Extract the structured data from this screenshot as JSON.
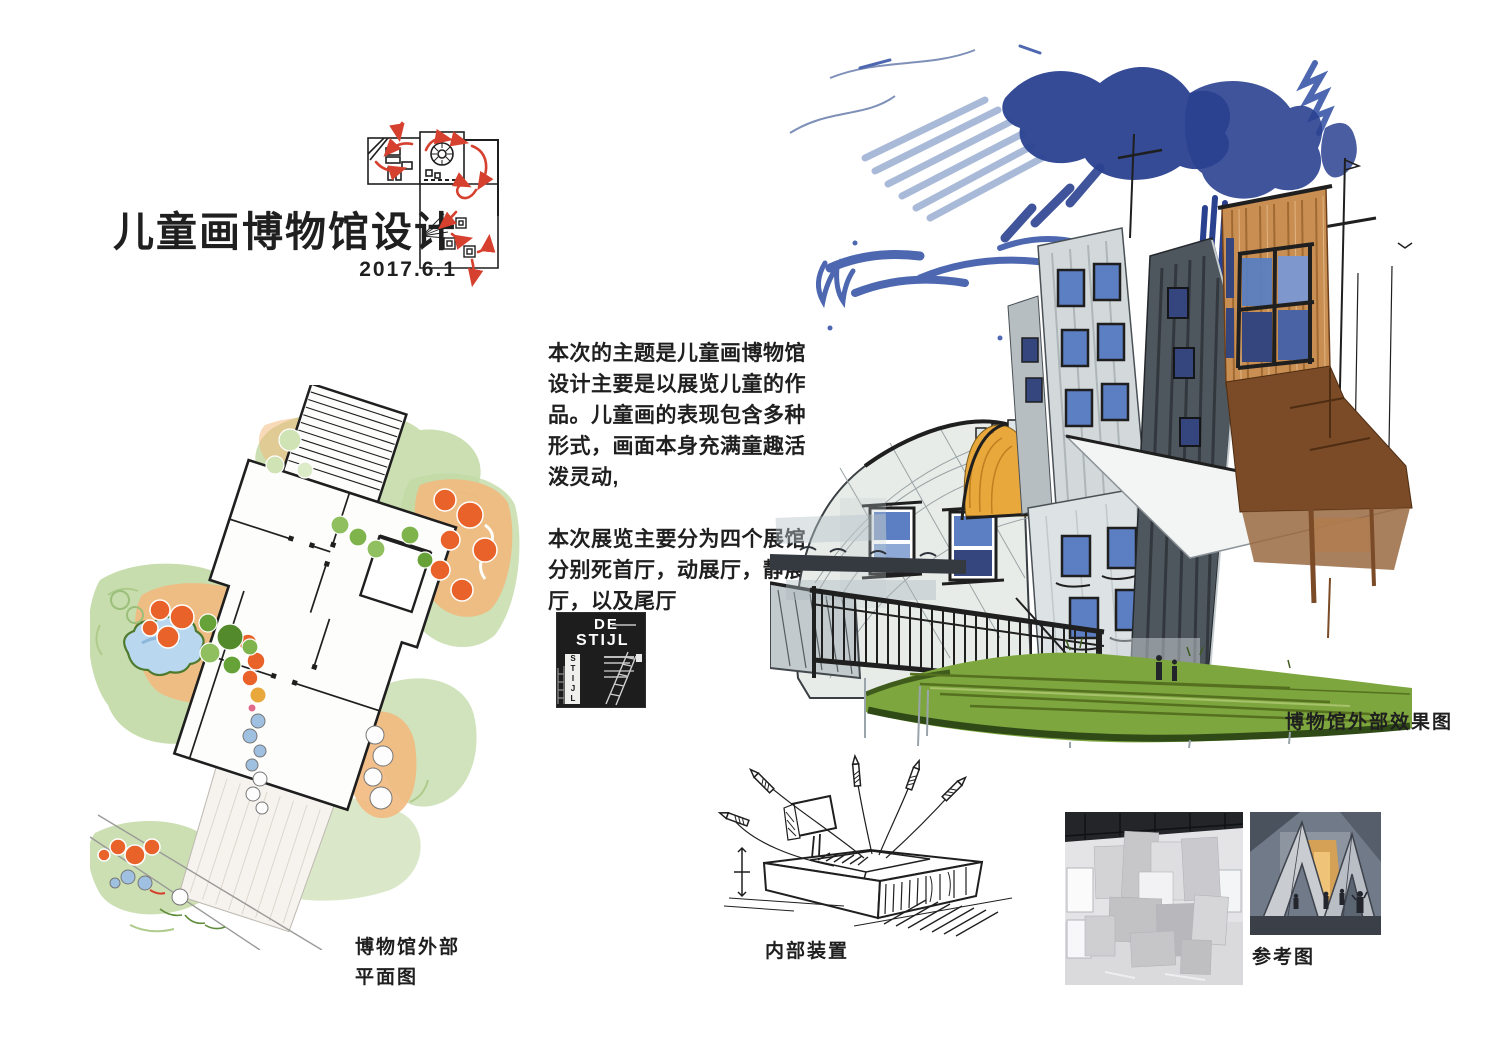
{
  "header": {
    "title": "儿童画博物馆设计",
    "date": "2017.6.1"
  },
  "intro": {
    "para1": "本次的主题是儿童画博物馆设计主要是以展览儿童的作品。儿童画的表现包含多种形式，画面本身充满童趣活泼灵动,",
    "para2": "本次展览主要分为四个展馆分别死首厅，动展厅，静展厅，以及尾厅"
  },
  "poster": {
    "word1": "DE",
    "word2": "STIJL",
    "vertical_word": "STIJL"
  },
  "captions": {
    "site_plan_line1": "博物馆外部",
    "site_plan_line2": "平面图",
    "exterior": "博物馆外部效果图",
    "installation": "内部装置",
    "reference": "参考图"
  },
  "colors": {
    "ink": "#1f1f1f",
    "red": "#d6412f",
    "sky-light": "#93a9cf",
    "sky-mid": "#4d68b0",
    "sky-dark": "#2a4190",
    "slab-light": "#d3d9db",
    "slab-mid": "#b6bec2",
    "slab-dark": "#4f575e",
    "window-blue": "#5b7fc2",
    "glass-dark": "#35467e",
    "yellow": "#e9a83c",
    "tan": "#c98e52",
    "brown": "#7b4a27",
    "lawn": "#7da63f",
    "lawn-dark": "#2f4a16",
    "plan-green": "#c2d9a5",
    "plan-green-mid": "#97c06c",
    "tree-green": "#66a238",
    "tree-orange": "#e8622a",
    "path-orange": "#f2b97e",
    "pond-blue": "#b9d7ee",
    "tree-blue": "#9fc0e0",
    "poster-bg": "#1d1d1d"
  }
}
